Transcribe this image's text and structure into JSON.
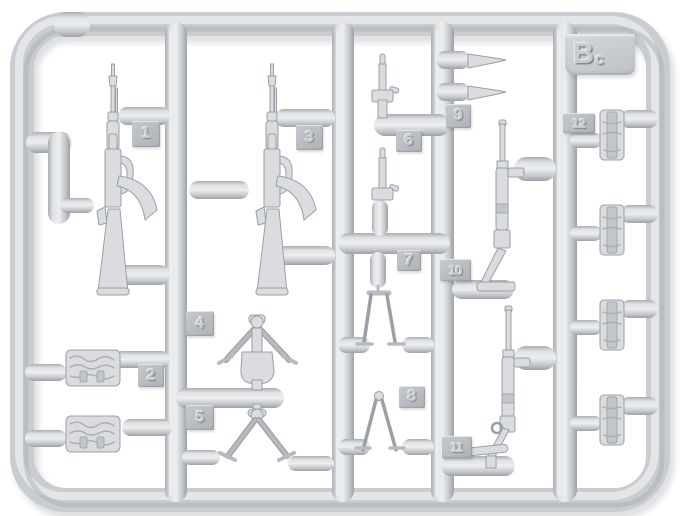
{
  "sprue": {
    "label": {
      "main": "B",
      "sub": "c",
      "full": "Bc"
    },
    "parts": [
      {
        "number": "1",
        "name": "assault-rifle-with-curved-magazine"
      },
      {
        "number": "2",
        "name": "ammo-pouch-horizontal"
      },
      {
        "number": "3",
        "name": "assault-rifle-with-curved-magazine"
      },
      {
        "number": "4",
        "name": "bipod-with-bell-mount"
      },
      {
        "number": "5",
        "name": "bipod-spread-legs"
      },
      {
        "number": "6",
        "name": "thin-rod-with-clamp"
      },
      {
        "number": "7",
        "name": "thin-rod-with-clamp"
      },
      {
        "number": "8",
        "name": "folded-bipod-legs"
      },
      {
        "number": "9",
        "name": "spiked-barrel-pair"
      },
      {
        "number": "10",
        "name": "submachine-gun-loop-stock"
      },
      {
        "number": "11",
        "name": "submachine-gun-t-bar-stock"
      },
      {
        "number": "12",
        "name": "magazine-pouch-vertical"
      }
    ],
    "colors": {
      "plastic": "#c9ccd0",
      "highlight": "#e9ebed",
      "shadow": "#a4a8ad",
      "tag": "#b9bdc2",
      "background": "#ffffff"
    }
  }
}
